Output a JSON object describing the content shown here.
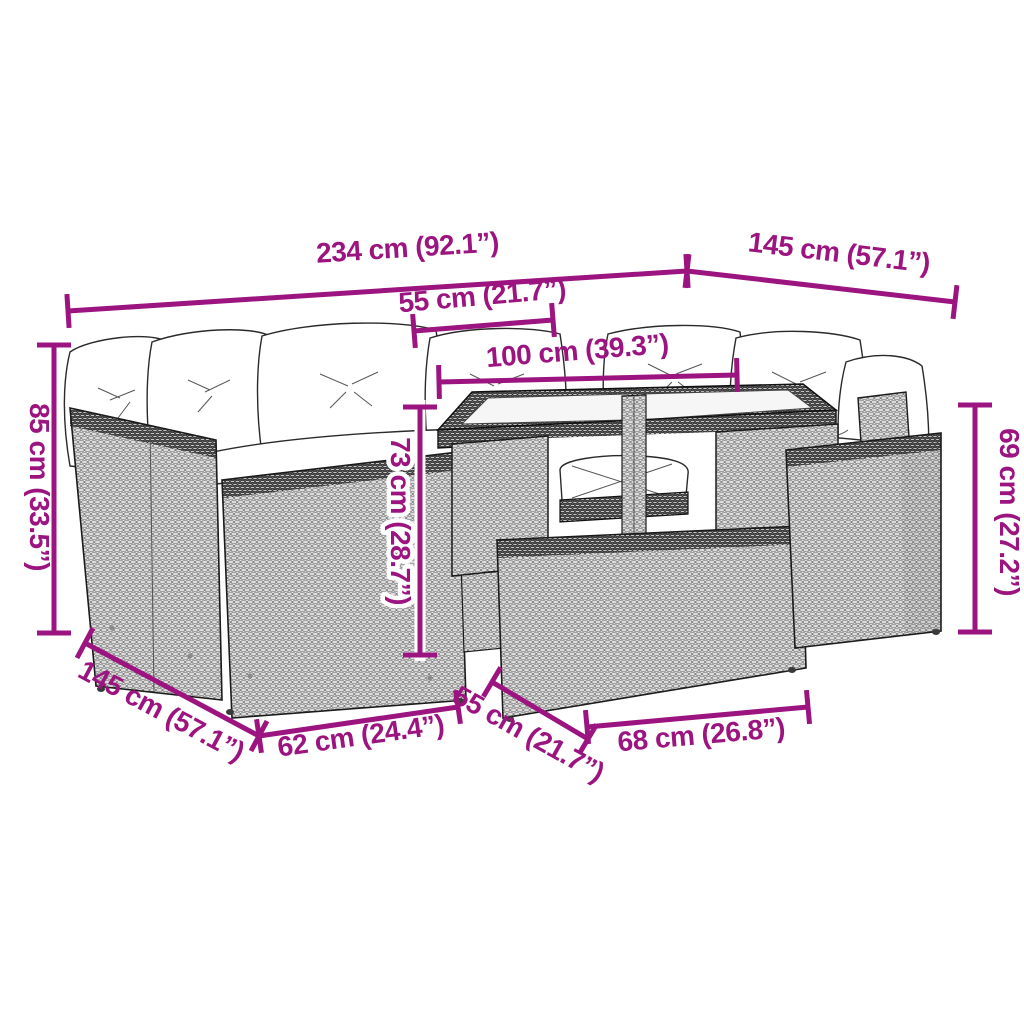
{
  "diagram": {
    "type": "product-dimension-diagram",
    "subject": "poly rattan garden lounge set with cushions and glass-top table",
    "background": "#ffffff",
    "accent_color": "#9C1480",
    "furniture_color_names": [
      "white cushions",
      "gray rattan weave"
    ],
    "dimensions": [
      {
        "id": "total-width",
        "label": "234 cm (92.1”)"
      },
      {
        "id": "right-section-width",
        "label": "145 cm (57.1”)"
      },
      {
        "id": "seat-width-top",
        "label": "55 cm (21.7”)"
      },
      {
        "id": "table-length",
        "label": "100 cm (39.3”)"
      },
      {
        "id": "back-height",
        "label": "85 cm (33.5”)"
      },
      {
        "id": "table-height",
        "label": "69 cm (27.2”)"
      },
      {
        "id": "seat-height",
        "label": "73 cm (28.7”)"
      },
      {
        "id": "left-section-depth",
        "label": "145 cm (57.1”)"
      },
      {
        "id": "ottoman-width",
        "label": "62 cm (24.4”)"
      },
      {
        "id": "front-seat-depth",
        "label": "55 cm (21.7”)"
      },
      {
        "id": "center-ottoman-width",
        "label": "68 cm (26.8”)"
      }
    ]
  }
}
